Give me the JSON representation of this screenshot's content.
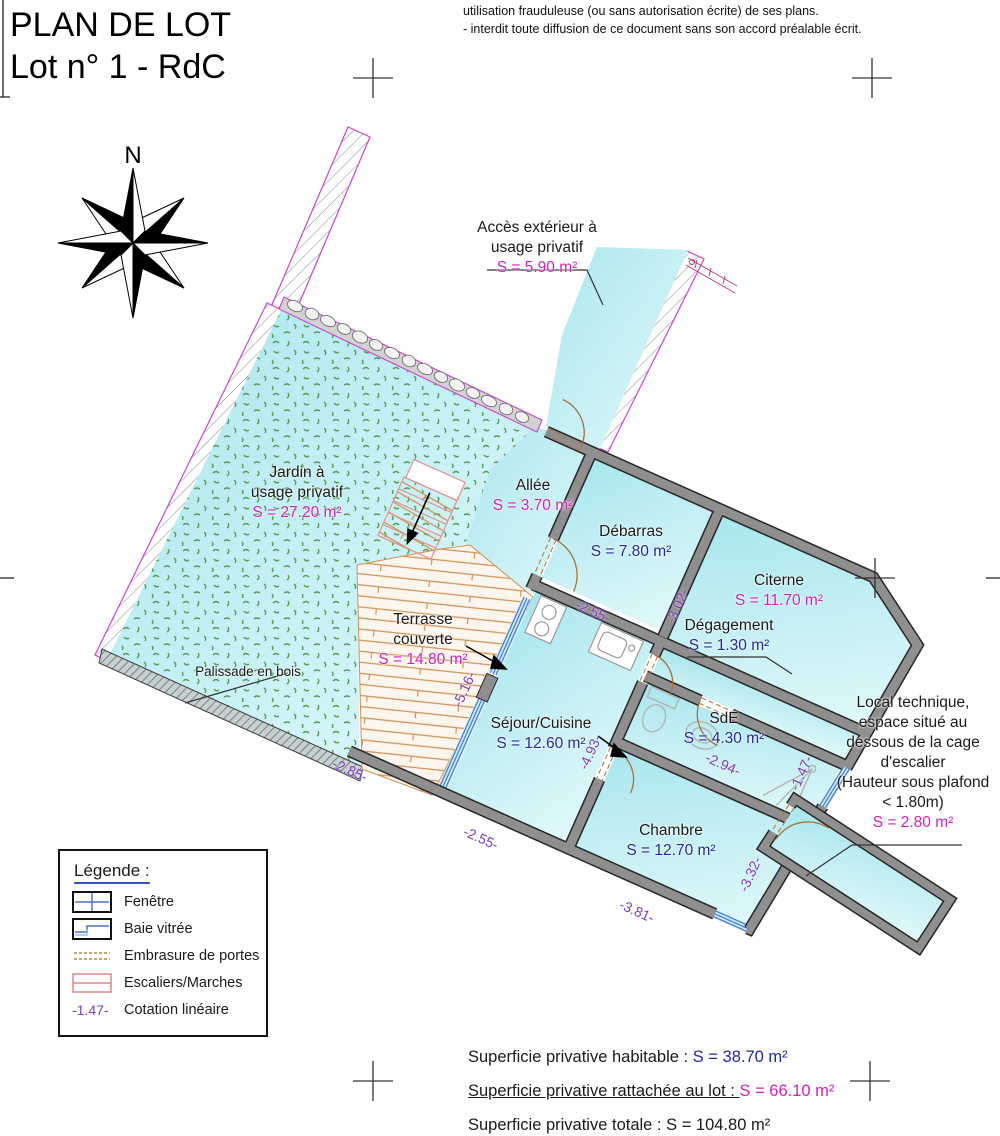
{
  "title": {
    "line1": "PLAN DE LOT",
    "line2": "Lot n° 1 - RdC"
  },
  "disclaimer": {
    "line1": "utilisation frauduleuse (ou sans autorisation écrite) de ses plans.",
    "line2": "- interdit toute diffusion de ce document sans son accord préalable écrit."
  },
  "compass": {
    "label": "N"
  },
  "rooms": [
    {
      "id": "acces-exterieur",
      "cx": 537,
      "y": 218,
      "lines": [
        [
          "Accès extérieur à",
          "n"
        ],
        [
          "usage privatif",
          "n"
        ],
        [
          "S = 5.90 m²",
          "m"
        ]
      ]
    },
    {
      "id": "jardin",
      "cx": 297,
      "y": 463,
      "lines": [
        [
          "Jardin à",
          "n"
        ],
        [
          "usage privatif",
          "n"
        ],
        [
          "S = 27.20 m²",
          "m"
        ]
      ]
    },
    {
      "id": "allee",
      "cx": 533,
      "y": 476,
      "lines": [
        [
          "Allée",
          "n"
        ],
        [
          "S = 3.70 m²",
          "m"
        ]
      ]
    },
    {
      "id": "debarras",
      "cx": 631,
      "y": 522,
      "lines": [
        [
          "Débarras",
          "n"
        ],
        [
          "S = 7.80 m²",
          "b"
        ]
      ]
    },
    {
      "id": "citerne",
      "cx": 779,
      "y": 571,
      "lines": [
        [
          "Citerne",
          "n"
        ],
        [
          "S = 11.70 m²",
          "m"
        ]
      ]
    },
    {
      "id": "degagement",
      "cx": 729,
      "y": 616,
      "lines": [
        [
          "Dégagement",
          "n"
        ],
        [
          "S = 1.30 m²",
          "b"
        ]
      ]
    },
    {
      "id": "terrasse",
      "cx": 423,
      "y": 610,
      "lines": [
        [
          "Terrasse",
          "n"
        ],
        [
          "couverte",
          "n"
        ],
        [
          "S = 14.80 m²",
          "m"
        ]
      ]
    },
    {
      "id": "sejour-cuisine",
      "cx": 541,
      "y": 714,
      "lines": [
        [
          "Séjour/Cuisine",
          "n"
        ],
        [
          "S = 12.60 m²",
          "b"
        ]
      ]
    },
    {
      "id": "sde",
      "cx": 724,
      "y": 709,
      "lines": [
        [
          "SdE",
          "n"
        ],
        [
          "S = 4.30 m²",
          "b"
        ]
      ]
    },
    {
      "id": "chambre",
      "cx": 671,
      "y": 821,
      "lines": [
        [
          "Chambre",
          "n"
        ],
        [
          "S = 12.70 m²",
          "b"
        ]
      ]
    },
    {
      "id": "local-technique",
      "cx": 913,
      "y": 693,
      "lines": [
        [
          "Local technique,",
          "n"
        ],
        [
          "espace situé au",
          "n"
        ],
        [
          "dessous de la cage",
          "n"
        ],
        [
          "d'escalier",
          "n"
        ],
        [
          "(Hauteur sous plafond",
          "n"
        ],
        [
          "< 1.80m)",
          "n"
        ],
        [
          "S = 2.80 m²",
          "m"
        ]
      ]
    },
    {
      "id": "palissade",
      "cx": 248,
      "y": 662,
      "fs": 13.5,
      "lines": [
        [
          "Palissade en bois",
          "n"
        ]
      ]
    }
  ],
  "dimensions": [
    {
      "v": "-3.02-",
      "x": 677,
      "y": 606,
      "r": -66
    },
    {
      "v": "-2.55-",
      "x": 593,
      "y": 611,
      "r": 24
    },
    {
      "v": "-5.16-",
      "x": 464,
      "y": 689,
      "r": -66
    },
    {
      "v": "-4.93-",
      "x": 590,
      "y": 752,
      "r": -66
    },
    {
      "v": "-2.94-",
      "x": 723,
      "y": 764,
      "r": 24
    },
    {
      "v": "-1.47-",
      "x": 801,
      "y": 773,
      "r": -66
    },
    {
      "v": "-3.32-",
      "x": 750,
      "y": 874,
      "r": -66
    },
    {
      "v": "-3.81-",
      "x": 637,
      "y": 911,
      "r": 24
    },
    {
      "v": "-2.55-",
      "x": 481,
      "y": 838,
      "r": 24
    },
    {
      "v": "-2.85-",
      "x": 350,
      "y": 770,
      "r": 24
    }
  ],
  "legend": {
    "title": "Légende :",
    "items": [
      "Fenêtre",
      "Baie vitrée",
      "Embrasure de portes",
      "Escaliers/Marches",
      "Cotation linéaire"
    ],
    "cotation_sample": "-1.47-"
  },
  "summary": [
    {
      "label": "Superficie privative habitable : ",
      "value": "S = 38.70 m²",
      "color": "blue",
      "underline": false
    },
    {
      "label": "Superficie privative rattachée au lot : ",
      "value": "S = 66.10 m²",
      "color": "magenta",
      "underline": true
    },
    {
      "label": "Superficie privative totale : ",
      "value": "S = 104.80 m²",
      "color": "black",
      "underline": false
    }
  ],
  "colors": {
    "magenta": "#cc22bb",
    "blue": "#202a9e",
    "black": "#1a1a1a",
    "cotation_purple": "#7a3bbd",
    "floor_cyan": "#c9eff5",
    "wall_gray": "#8f8f8f",
    "terrace_orange": "#cf9055",
    "boundary_magenta": "#cc44cc"
  }
}
